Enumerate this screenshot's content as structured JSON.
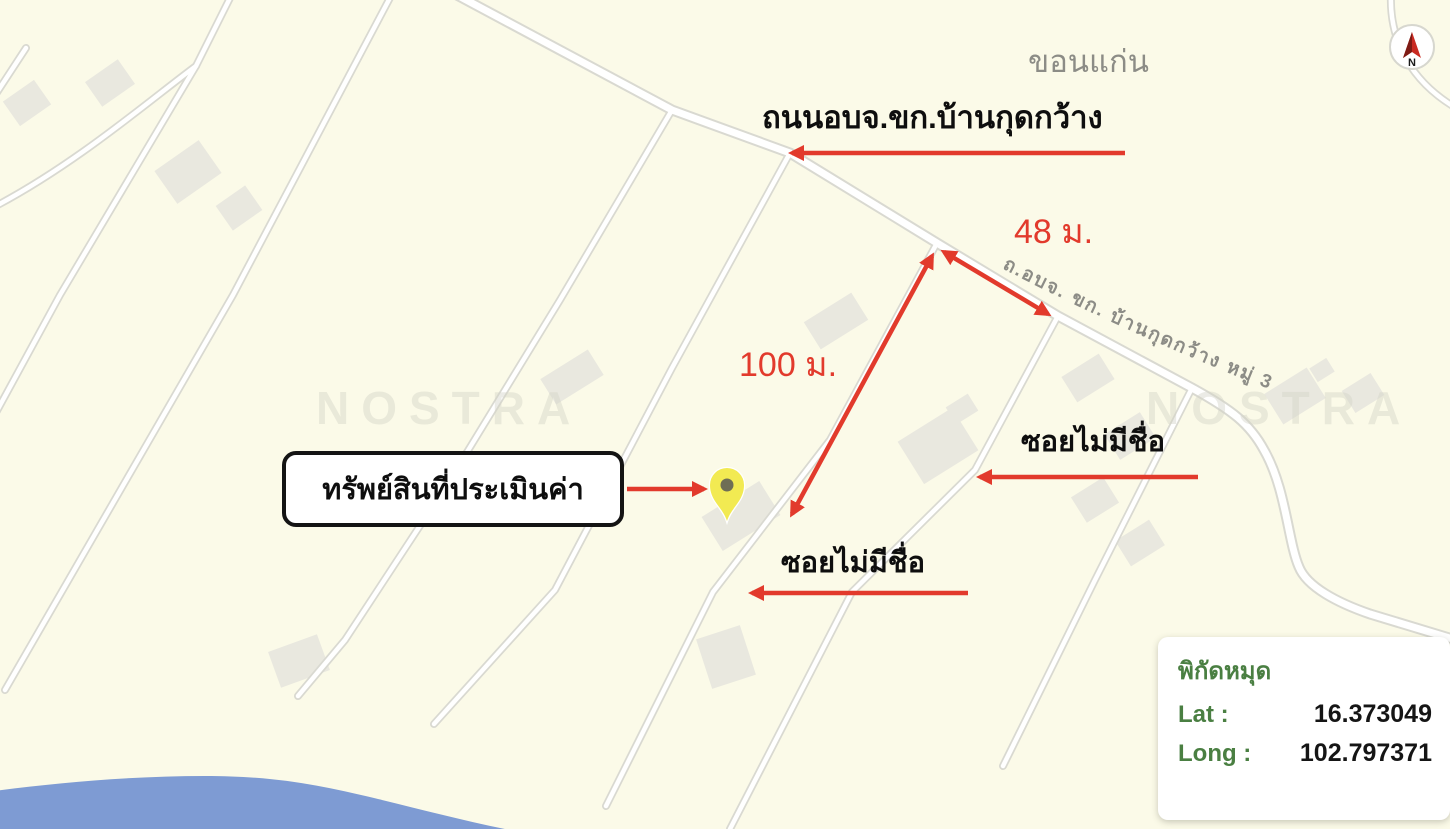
{
  "map": {
    "province_label": "ขอนแก่น",
    "road_name_label": "ถนนอบจ.ขก.บ้านกุดกว้าง",
    "road_inline_label": "ถ.อบจ. ขก. บ้านกุดกว้าง หมู่ 3",
    "distance_48": "48 ม.",
    "distance_100": "100 ม.",
    "soi_label_right": "ซอยไม่มีชื่อ",
    "soi_label_bottom": "ซอยไม่มีชื่อ",
    "property_label": "ทรัพย์สินที่ประเมินค่า",
    "watermark": "NOSTRA",
    "compass_n": "N"
  },
  "coords_panel": {
    "title": "พิกัดหมุด",
    "lat_label": "Lat :",
    "lat_value": "16.373049",
    "long_label": "Long :",
    "long_value": "102.797371"
  },
  "colors": {
    "background": "#fbfae8",
    "road_casing": "#d9d9d1",
    "building": "#e9e8df",
    "water": "#7e9bd3",
    "annotation_red": "#e23a2c",
    "label_green": "#4a7f42",
    "muted_gray": "#8c8c86",
    "watermark_gray": "#d5d5c8",
    "pin_yellow": "#f2ea52"
  }
}
